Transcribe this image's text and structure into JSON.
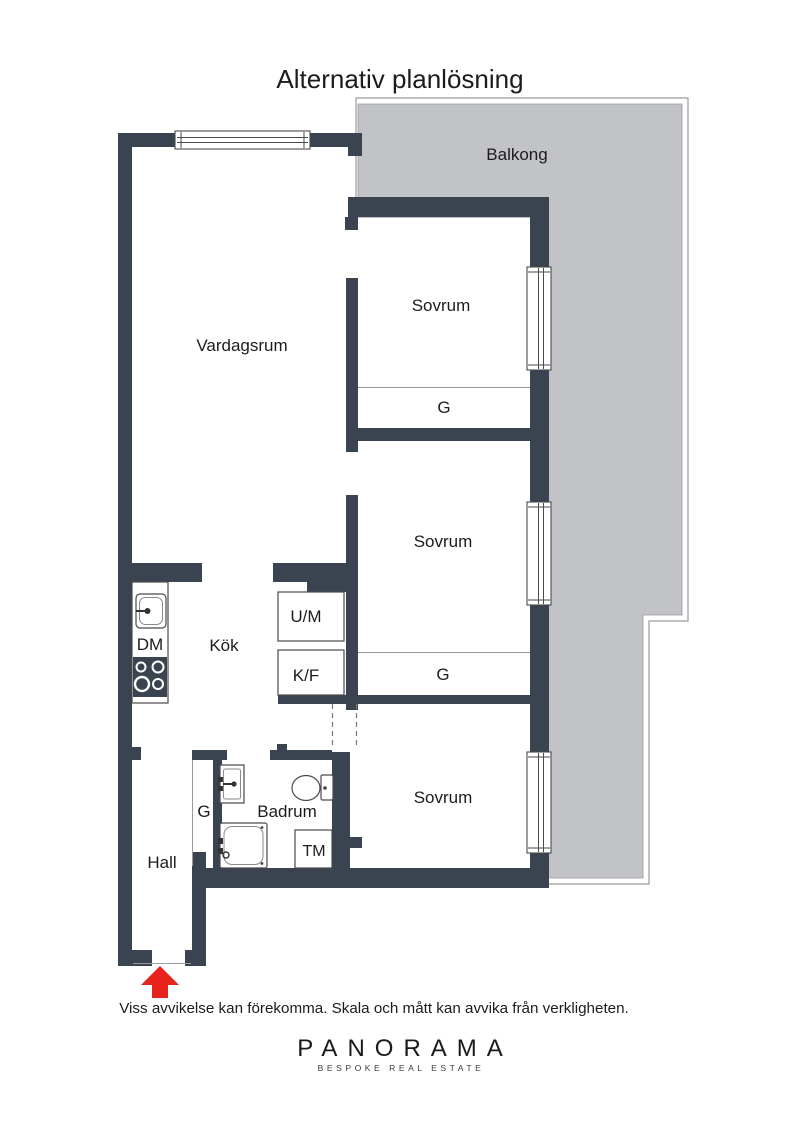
{
  "title": "Alternativ planlösning",
  "plan": {
    "rooms": {
      "balkong": "Balkong",
      "vardagsrum": "Vardagsrum",
      "sovrum_1": "Sovrum",
      "sovrum_2": "Sovrum",
      "sovrum_3": "Sovrum",
      "kok": "Kök",
      "badrum": "Badrum",
      "hall": "Hall"
    },
    "closets": {
      "g_1": "G",
      "g_2": "G",
      "g_3": "G"
    },
    "appliances": {
      "dm": "DM",
      "um": "U/M",
      "kf": "K/F",
      "tm": "TM"
    }
  },
  "colors": {
    "wall": "#3a4451",
    "balcony_fill": "#c2c3c7",
    "balcony_outline": "#9a9a9e",
    "entry_arrow": "#e7231b",
    "text": "#1c1c1c"
  },
  "footer": {
    "disclaimer": "Viss avvikelse kan förekomma. Skala och mått kan avvika från verkligheten.",
    "brand_name": "PANORAMA",
    "brand_tagline": "BESPOKE REAL ESTATE"
  }
}
